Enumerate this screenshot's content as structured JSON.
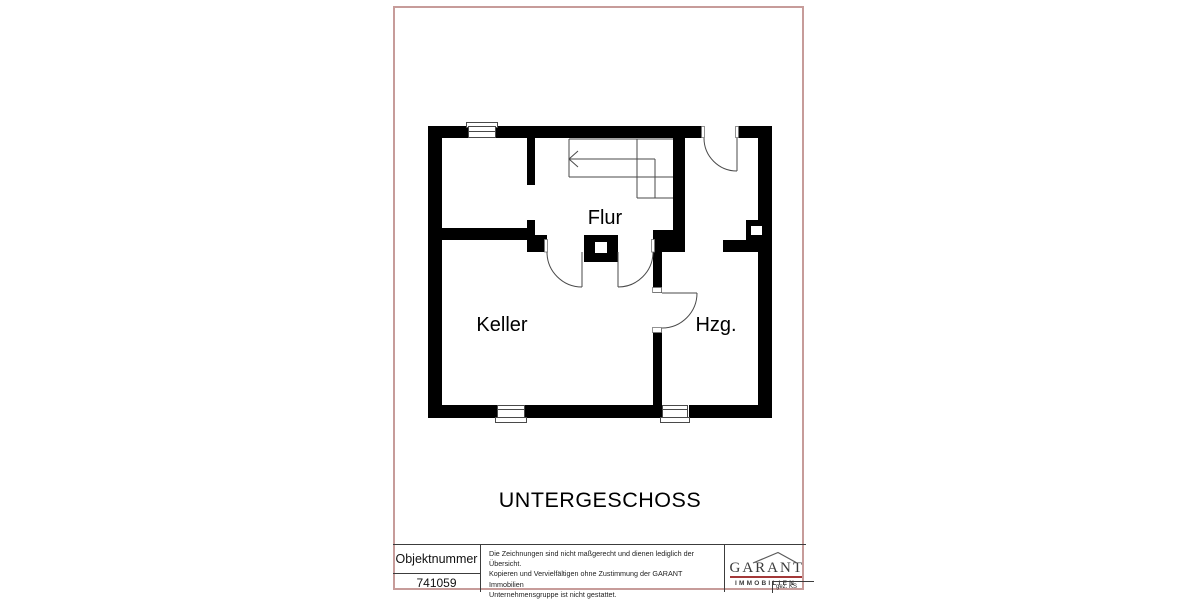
{
  "plan": {
    "title": "UNTERGESCHOSS",
    "rooms": {
      "flur": {
        "label": "Flur"
      },
      "keller": {
        "label": "Keller"
      },
      "heating": {
        "label": "Hzg."
      }
    }
  },
  "title_block": {
    "object_number": {
      "label": "Objektnummer",
      "value": "741059"
    },
    "disclaimer_lines": [
      "Die Zeichnungen sind nicht maßgerecht und dienen lediglich der Übersicht.",
      "Kopieren und Vervielfältigen ohne Zustimmung der GARANT Immobilien",
      "Unternehmensgruppe ist nicht gestattet."
    ],
    "signature": "gez. KS",
    "logo": {
      "name": "GARANT",
      "subtitle": "IMMOBILIEN"
    }
  },
  "colors": {
    "frame": "#c79c9a",
    "block_line": "#3c3c3c",
    "wall": "#000000",
    "thin_line": "#4a4a4a",
    "accent_red": "#a33838"
  }
}
